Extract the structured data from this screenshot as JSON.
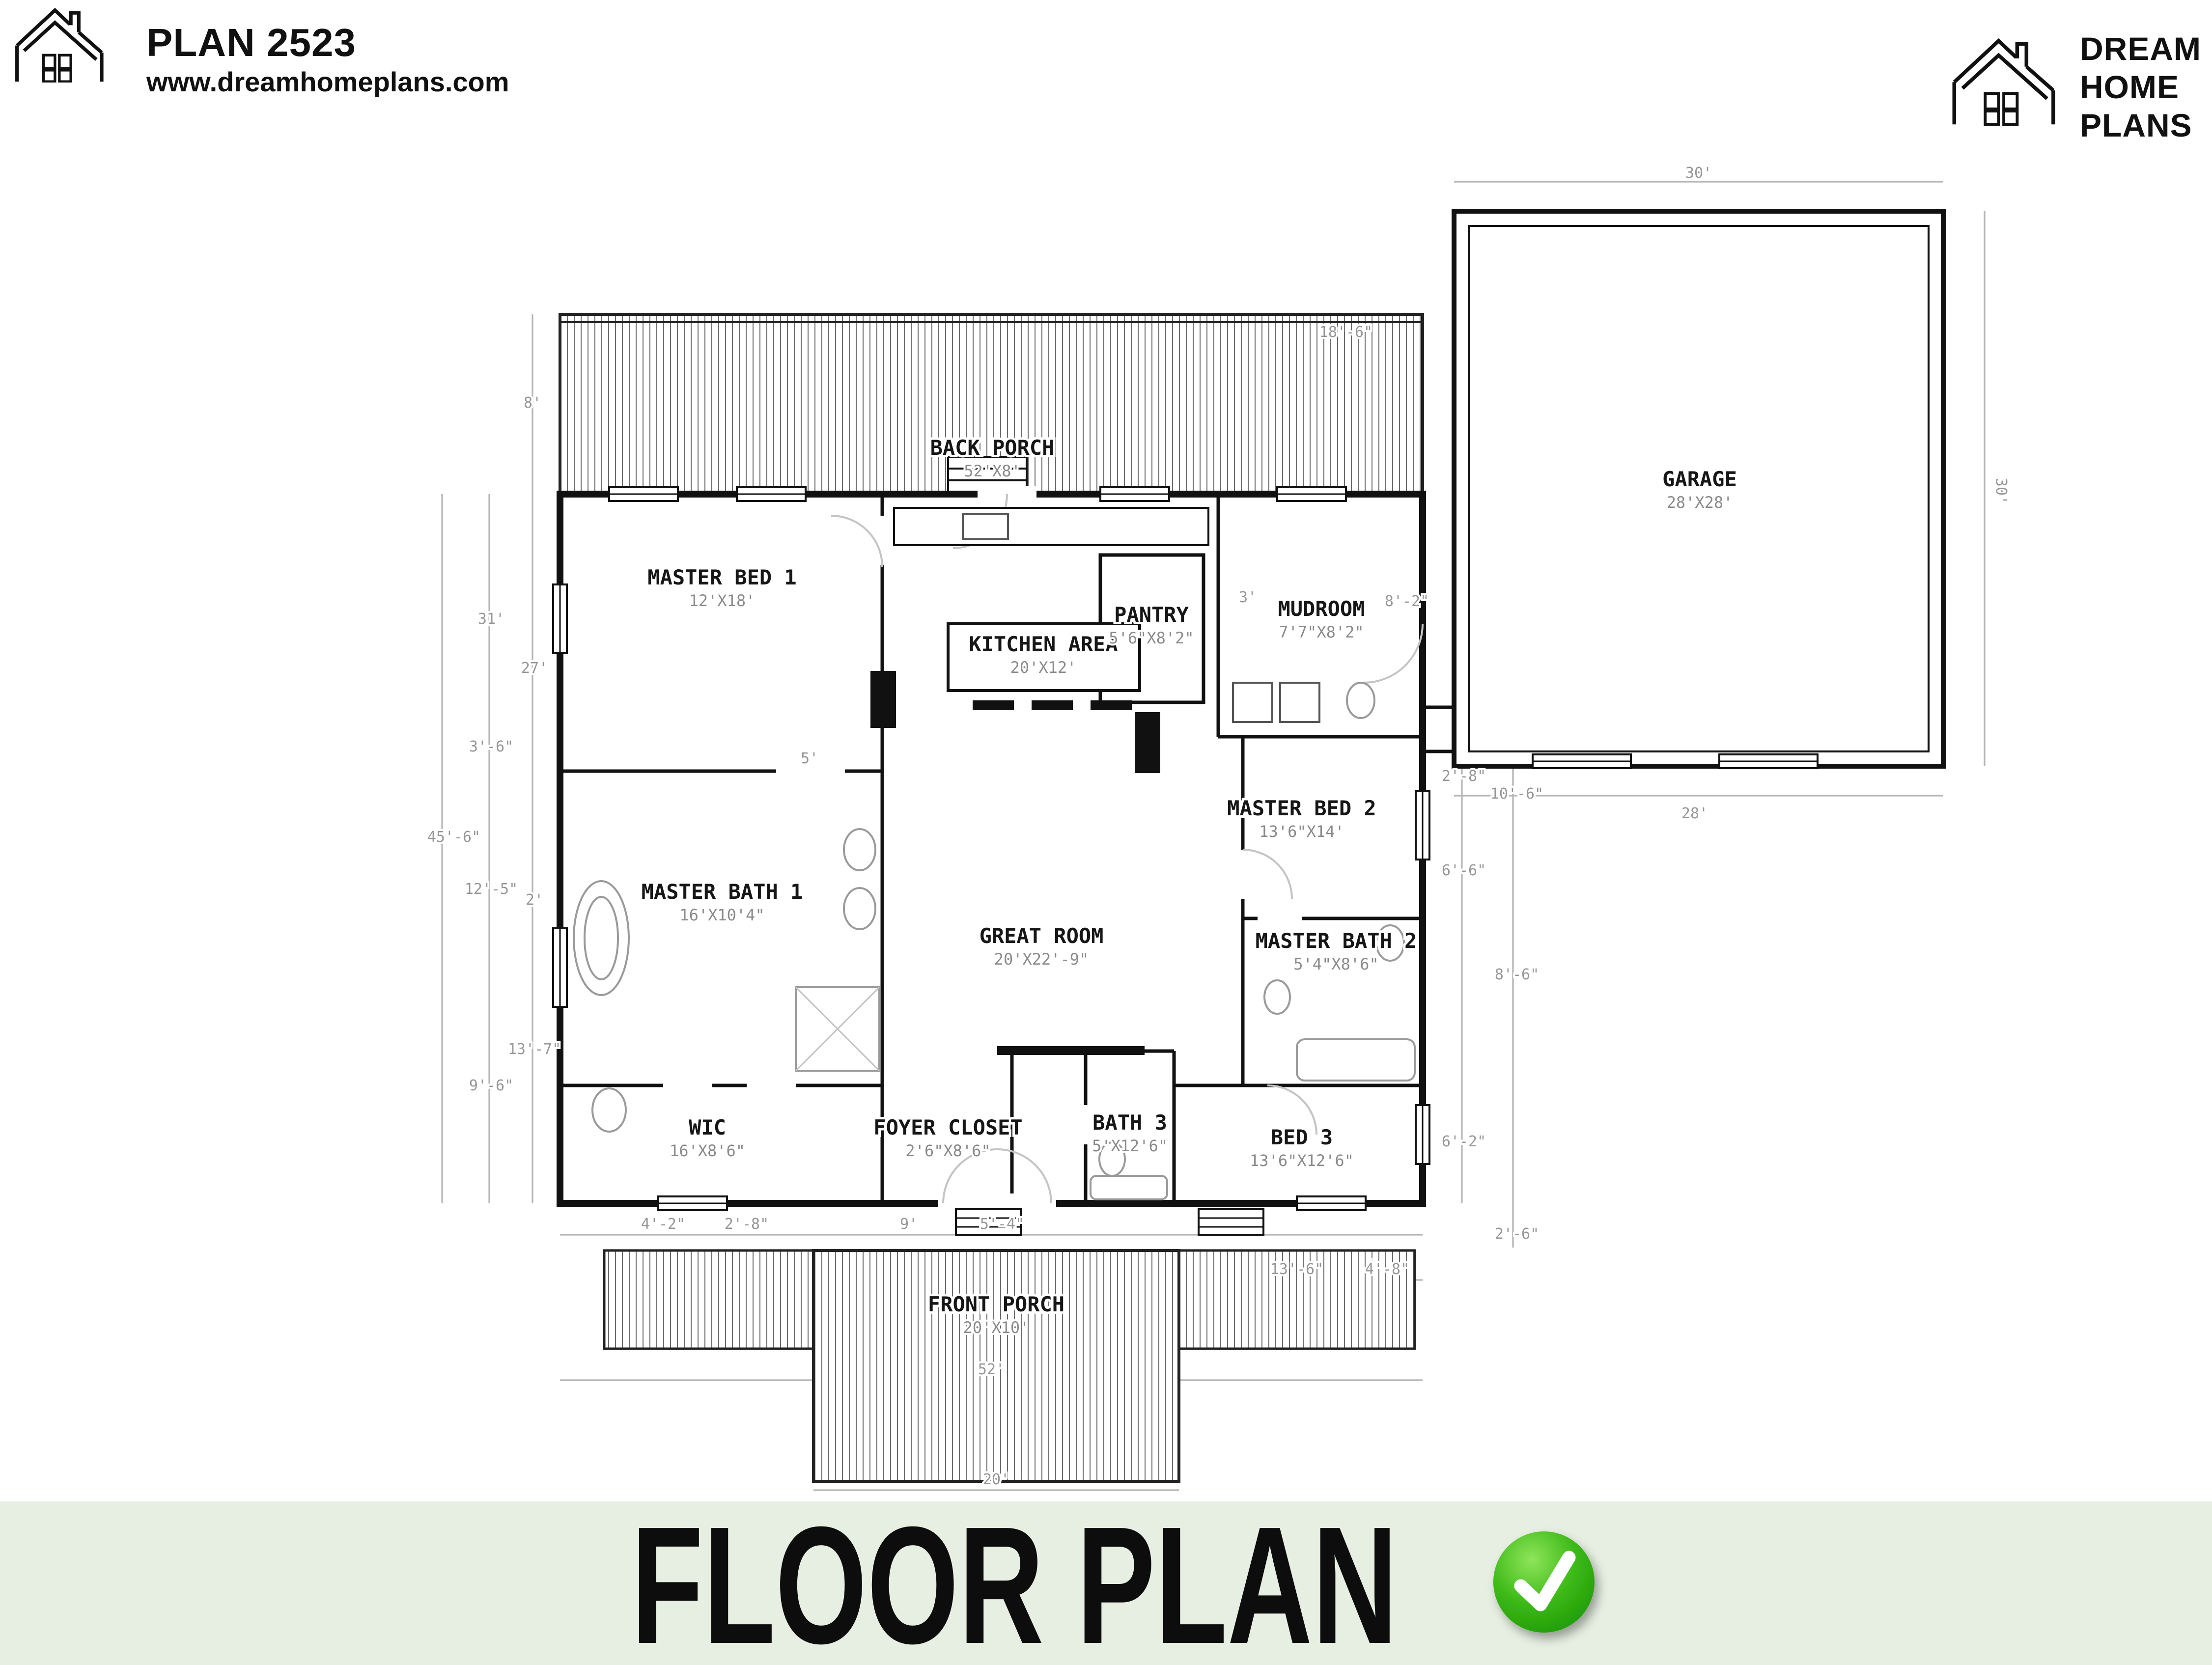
{
  "header": {
    "plan_title": "PLAN 2523",
    "website": "www.dreamhomeplans.com",
    "icon": "house-outline-icon"
  },
  "brand": {
    "line1": "DREAM",
    "line2": "HOME",
    "line3": "PLANS",
    "icon": "house-outline-icon"
  },
  "banner": {
    "title": "FLOOR PLAN",
    "icon": "green-checkmark-icon",
    "background_color": "#e7efe2",
    "check_color": "#2fae10"
  },
  "floorplan": {
    "rooms": [
      {
        "name": "MASTER BED 1",
        "size": "12'X18'"
      },
      {
        "name": "KITCHEN AREA",
        "size": "20'X12'"
      },
      {
        "name": "PANTRY",
        "size": "5'6\"X8'2\""
      },
      {
        "name": "MUDROOM",
        "size": "7'7\"X8'2\""
      },
      {
        "name": "MASTER BED 2",
        "size": "13'6\"X14'"
      },
      {
        "name": "MASTER BATH 2",
        "size": "5'4\"X8'6\""
      },
      {
        "name": "GREAT ROOM",
        "size": "20'X22'-9\""
      },
      {
        "name": "MASTER BATH 1",
        "size": "16'X10'4\""
      },
      {
        "name": "WIC",
        "size": "16'X8'6\""
      },
      {
        "name": "FOYER CLOSET",
        "size": "2'6\"X8'6\""
      },
      {
        "name": "BATH 3",
        "size": "5'X12'6\""
      },
      {
        "name": "BED 3",
        "size": "13'6\"X12'6\""
      },
      {
        "name": "GARAGE",
        "size": "28'X28'"
      },
      {
        "name": "BACK PORCH",
        "size": "52'X8'"
      },
      {
        "name": "FRONT PORCH",
        "size": "20'X10'"
      }
    ],
    "dims": [
      "30'",
      "30'",
      "28'",
      "18'-6\"",
      "8'",
      "45'-6\"",
      "31'",
      "3'-6\"",
      "12'-5\"",
      "9'-6\"",
      "27'",
      "2'",
      "13'-7\"",
      "8'-2\"",
      "3'",
      "2'-8\"",
      "10'-6\"",
      "6'-6\"",
      "8'-6\"",
      "6'-2\"",
      "2'-6\"",
      "52'",
      "20'",
      "13'-6\"",
      "4'-8\"",
      "5'-4\"",
      "9'",
      "4'-2\"",
      "5'",
      "2'-8\""
    ]
  }
}
